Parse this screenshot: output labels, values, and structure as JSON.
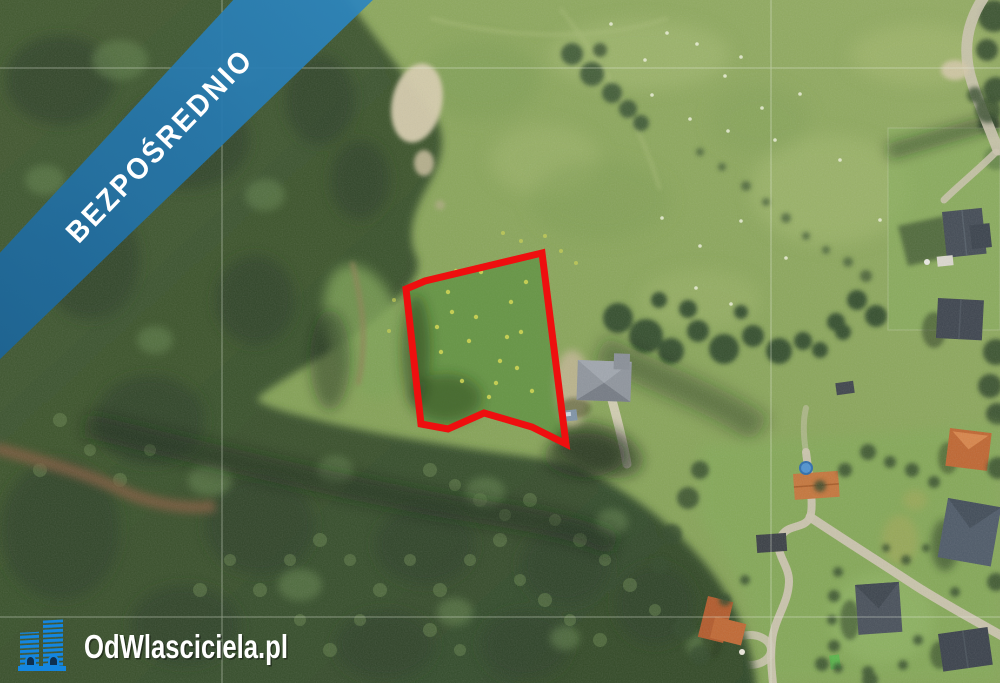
{
  "banner": {
    "label": "BEZPOŚREDNIO",
    "background_color": "#2478ad",
    "text_color": "#ffffff"
  },
  "logo": {
    "text": "OdWlasciciela.pl",
    "text_color": "#ffffff",
    "icon_color": "#1486e0"
  },
  "plot": {
    "outline_color": "#ee0f0f"
  },
  "scene": {
    "type": "satellite-aerial-photo",
    "features": [
      "forest",
      "meadow",
      "marked-plot",
      "field",
      "houses",
      "roads",
      "grid-lines"
    ]
  }
}
